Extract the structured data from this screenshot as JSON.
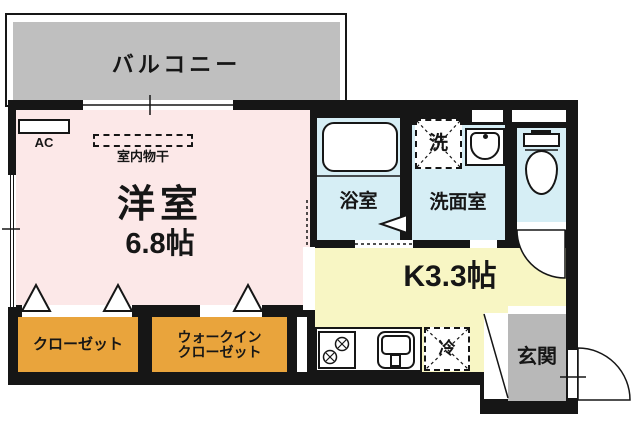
{
  "colors": {
    "wall_black": "#161616",
    "room_pink": "#fce8e8",
    "wet_blue": "#d6eef5",
    "kitchen_yellow": "#f8f6c4",
    "closet_orange": "#e9a43c",
    "balcony_gray": "#bfbfbf",
    "entrance_gray": "#b8b8b8"
  },
  "rooms": {
    "balcony": {
      "label": "バルコニー"
    },
    "living": {
      "name": "洋室",
      "size": "6.8帖",
      "ac_label": "AC",
      "indoor_drying_label": "室内物干"
    },
    "bath": {
      "name": "浴室"
    },
    "washroom": {
      "name": "洗面室",
      "washer_label": "洗"
    },
    "kitchen": {
      "name": "K3.3帖",
      "fridge_label": "冷"
    },
    "closet": {
      "label": "クローゼット"
    },
    "walk_in_closet": {
      "label_line1": "ウォークイン",
      "label_line2": "クローゼット"
    },
    "entrance": {
      "label": "玄関"
    }
  }
}
